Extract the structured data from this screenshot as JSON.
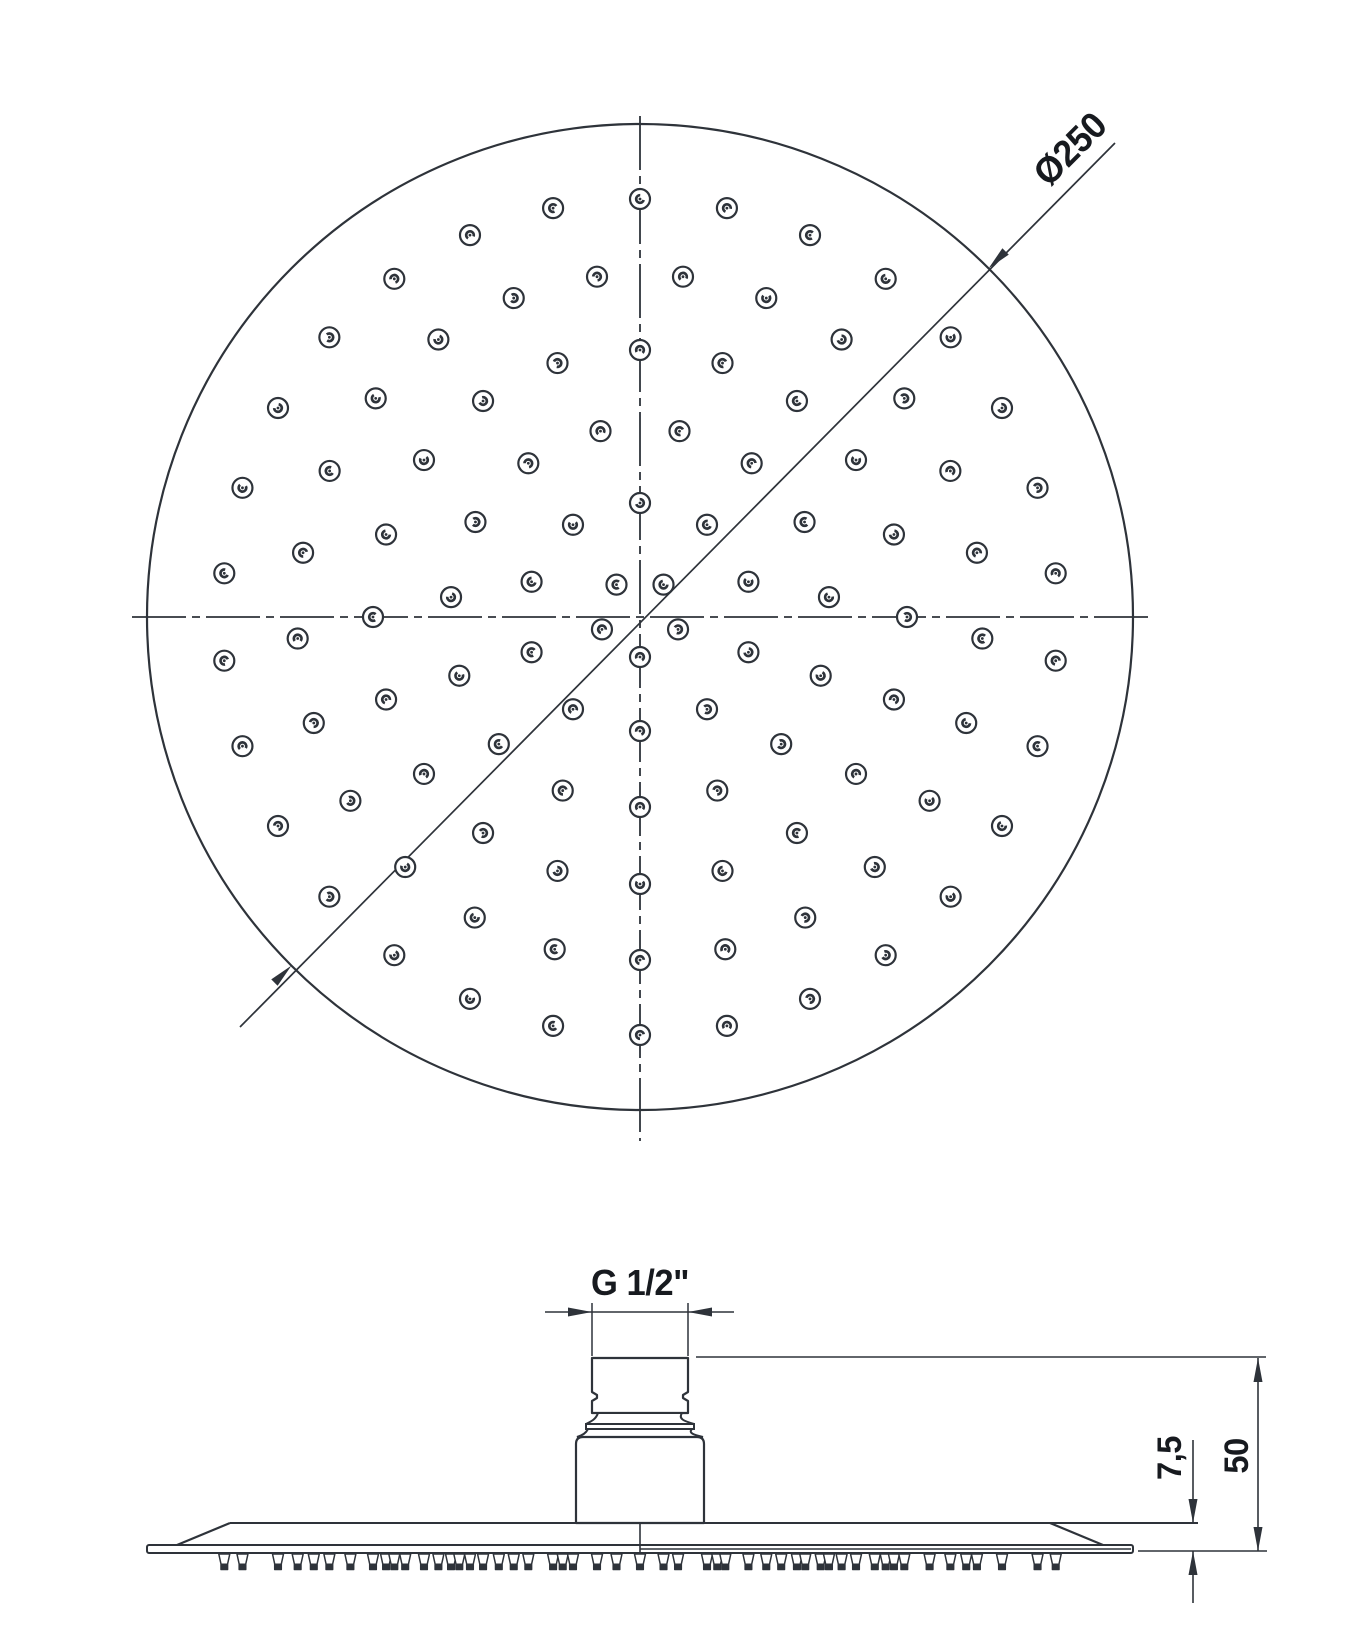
{
  "labels": {
    "diameter": "Ø250",
    "thread": "G 1/2\"",
    "plate_thickness": "7,5",
    "head_height": "50"
  },
  "colors": {
    "line": "#2e333a",
    "text": "#171a1f",
    "background": "#ffffff"
  },
  "top_view": {
    "center_x": 640,
    "center_y": 617,
    "radius": 493,
    "centerline_vertical": {
      "y1": 116,
      "y2": 1141
    },
    "centerline_horizontal": {
      "x1": 132,
      "x2": 1148
    },
    "diameter_leader": {
      "x1": 240,
      "y1": 1027,
      "x2": 1115,
      "y2": 143
    },
    "nozzle_rings": [
      {
        "radius": 40,
        "count": 5,
        "start_deg": 54
      },
      {
        "radius": 114,
        "count": 10,
        "start_deg": 90
      },
      {
        "radius": 190,
        "count": 15,
        "start_deg": 78
      },
      {
        "radius": 267,
        "count": 20,
        "start_deg": 90
      },
      {
        "radius": 343,
        "count": 25,
        "start_deg": 82.8
      },
      {
        "radius": 418,
        "count": 30,
        "start_deg": 90
      }
    ],
    "nozzle_glyph": {
      "outer_r": 10,
      "inner_r": 3.8,
      "dot_r": 1.4
    }
  },
  "side_view": {
    "center_x": 640,
    "thread": {
      "x1": 592,
      "x2": 688,
      "y1": 1358,
      "y2": 1413,
      "notch_y1": 1392,
      "notch_y2": 1401,
      "notch_depth": 5
    },
    "bell": {
      "top_x1": 598,
      "top_x2": 682,
      "bot_x1": 586,
      "bot_x2": 694,
      "y1": 1413,
      "y2": 1424,
      "band_y2": 1429
    },
    "skirt": {
      "x1": 588,
      "x2": 692,
      "y1": 1429,
      "bx1": 577,
      "bx2": 703,
      "y2": 1437
    },
    "body": {
      "x1": 576,
      "x2": 704,
      "top_y": 1437,
      "bottom_y": 1523,
      "corner": 7
    },
    "plate": {
      "face_y": 1523,
      "face_x1": 230,
      "face_x2": 1198,
      "bevel_left": {
        "x1": 230,
        "x2": 177
      },
      "bevel_right": {
        "x1": 1050,
        "x2": 1103
      },
      "slab_x1": 147,
      "slab_x2": 1133,
      "slab_y1": 1545,
      "slab_y2": 1553,
      "seam_x": 640,
      "inner_line_y": 1549,
      "inner_line_x2": 1131
    },
    "nubs": {
      "top_y": 1554,
      "mid_y": 1564,
      "bot_y": 1569.5,
      "half_top": 5.5,
      "half_bot": 3.3,
      "merge_gap": 8
    },
    "dims": {
      "thread_dim": {
        "line_y": 1312,
        "ext_y1": 1303,
        "ext_y2": 1356,
        "tail_left_x": 545,
        "tail_right_x": 734
      },
      "ext_top": {
        "y": 1357,
        "x1": 696,
        "x2": 1266
      },
      "ext_plate_bot": {
        "y": 1551,
        "x1": 1138,
        "x2": 1267
      },
      "dim50": {
        "x": 1258,
        "y1": 1358,
        "y2": 1551
      },
      "dim75": {
        "x": 1193,
        "top_tail_y": 1440,
        "top_tip_y": 1523,
        "bot_tip_y": 1551,
        "bot_tail_y": 1603
      },
      "arrow": {
        "length": 24,
        "half_width": 4.5
      }
    }
  }
}
